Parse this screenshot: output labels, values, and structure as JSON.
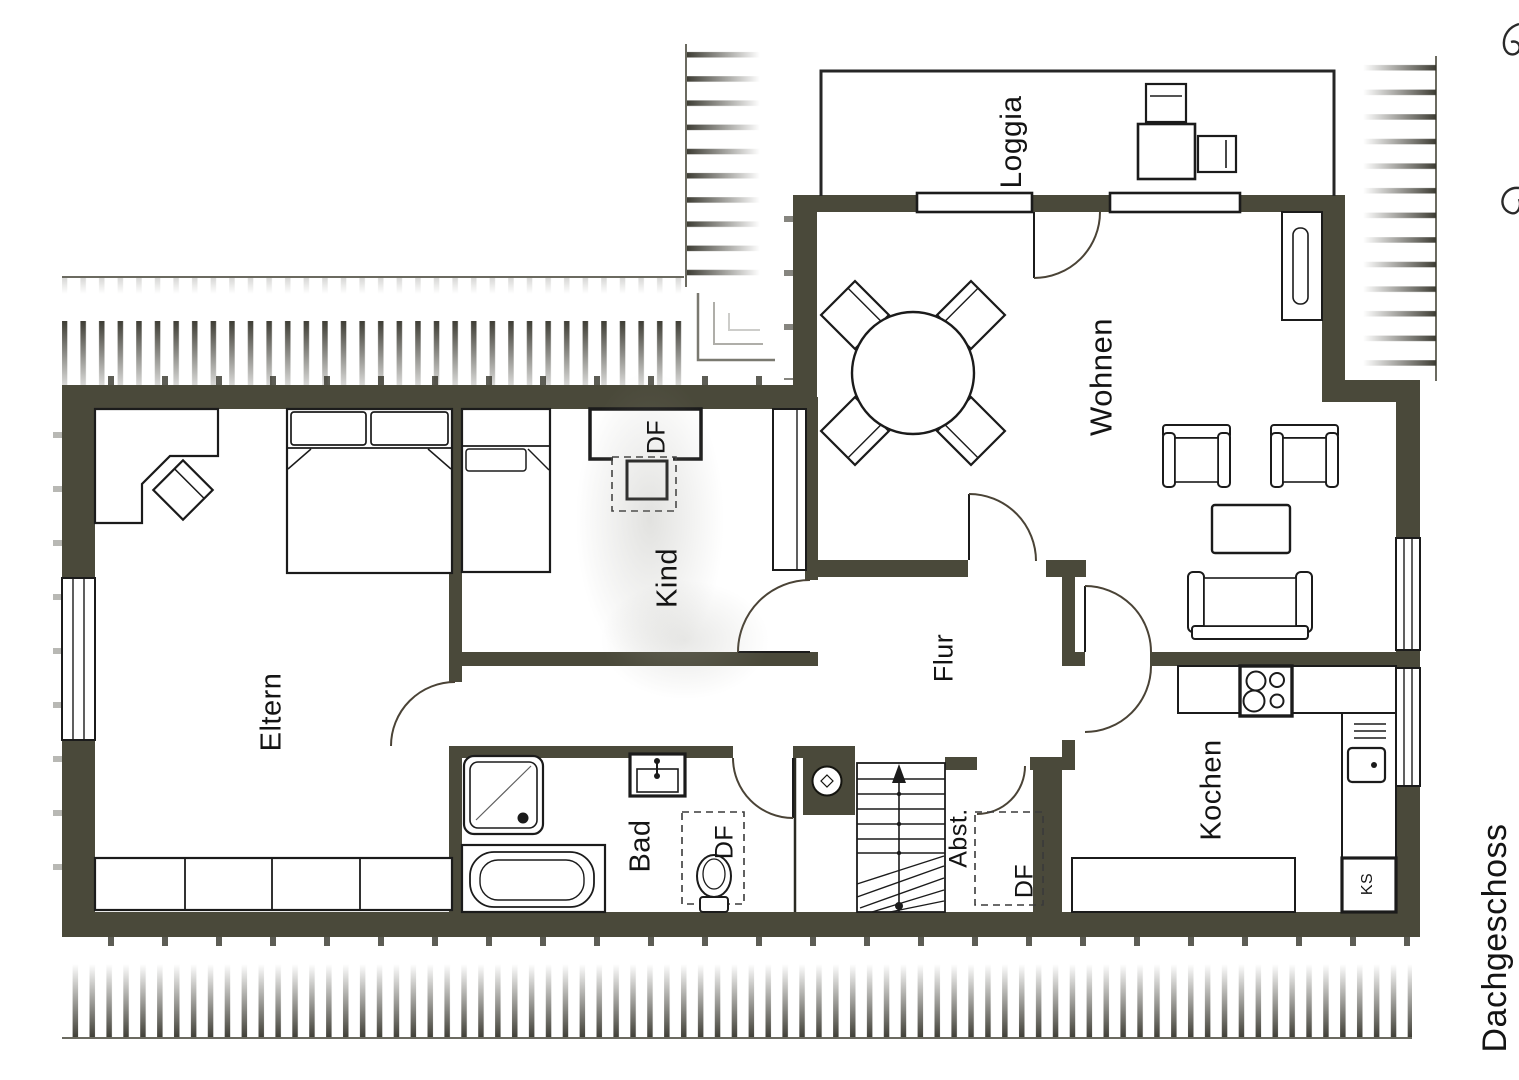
{
  "page": {
    "background": "#ffffff"
  },
  "colors": {
    "wall": "#4a493a",
    "line": "#1b1b1b",
    "hatch": "#34332a",
    "text": "#141414"
  },
  "labels": {
    "loggia": "Loggia",
    "wohnen": "Wohnen",
    "kind": "Kind",
    "eltern": "Eltern",
    "flur": "Flur",
    "bad": "Bad",
    "kochen": "Kochen",
    "abstell": "Abst.",
    "df_kind": "DF",
    "df_bad": "DF",
    "df_abst": "DF",
    "fridge": "KS",
    "floor": "Dachgeschoss"
  },
  "icons": {
    "stairs_direction_arrow": "up-arrow"
  }
}
